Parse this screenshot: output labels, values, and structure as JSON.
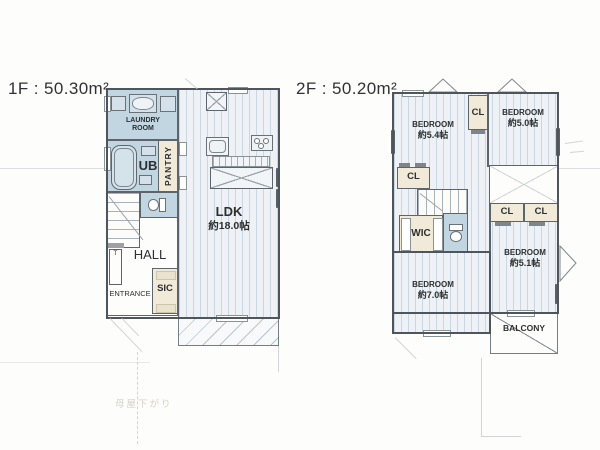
{
  "floor1": {
    "title": "1F : 50.30m²",
    "rooms": {
      "laundry": {
        "line1": "LAUNDRY",
        "line2": "ROOM"
      },
      "ub": "UB",
      "pantry": "PANTRY",
      "toilet": "toilet",
      "hall": "HALL",
      "cabinet": "T",
      "entrance": "ENTRANCE",
      "sic": "SIC",
      "ldk": {
        "name": "LDK",
        "size": "約18.0帖"
      }
    },
    "note": "母屋下がり"
  },
  "floor2": {
    "title": "2F : 50.20m²",
    "rooms": {
      "bedroom_top_left": {
        "name": "BEDROOM",
        "size": "約5.4帖"
      },
      "bedroom_top_right": {
        "name": "BEDROOM",
        "size": "約5.0帖"
      },
      "bedroom_bottom_left": {
        "name": "BEDROOM",
        "size": "約7.0帖"
      },
      "bedroom_bottom_right": {
        "name": "BEDROOM",
        "size": "約5.1帖"
      },
      "closet": "CL",
      "wic": "WIC",
      "balcony": "BALCONY"
    }
  },
  "colors": {
    "wet_area": "#c2d6e2",
    "closet_area": "#f1ead8",
    "floor_base": "#eef2f6",
    "wall": "#4e555c",
    "faint_pencil": "#d8d1c9"
  }
}
